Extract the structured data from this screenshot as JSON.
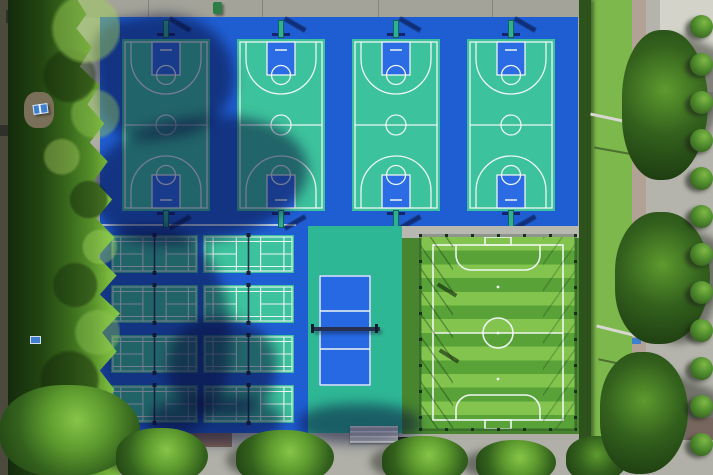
{
  "scene": {
    "type": "aerial-drone-photo",
    "description": "Top-down aerial view of an outdoor sports complex: four basketball courts along the north side, a grid of badminton courts and a volleyball court in the south-west, and a fenced artificial-turf football pitch in the south-east. A dense tree line borders the west edge, a row of trees the south edge, and on the east a hedge, lawn, footpath and road lined with round shrubs.",
    "facilities": [
      {
        "name": "basketball-court",
        "count": 4,
        "surface": "green acrylic with blue keys and white lines"
      },
      {
        "name": "badminton-court",
        "count": 8,
        "arrangement": "2 columns x 4 rows with nets"
      },
      {
        "name": "volleyball-court",
        "count": 1,
        "surface": "blue court on teal surround with net"
      },
      {
        "name": "football-pitch",
        "count": 1,
        "surface": "striped artificial turf, fenced, goals at both ends"
      },
      {
        "name": "table-tennis-table",
        "count": 1,
        "location": "clearing in west tree line"
      }
    ],
    "surroundings": [
      "concrete apron along north edge",
      "tree line west",
      "tree row south over pavement",
      "hedge + lawn + footpath + road east",
      "round shrub row along east road"
    ]
  },
  "counts": {
    "basketball_courts": 4,
    "badminton_rows": 4,
    "badminton_cols": 2,
    "east_shrubs": 12,
    "turf_stripe_height_px": 13.7
  },
  "colors": {
    "pavement_top": "#a3a399",
    "pavement_bottom": "#b0b0a8",
    "road_gray": "#b4b4ac",
    "path_tan": "#b2a296",
    "grass_green": "#7cb84c",
    "hedge_green": "#2d521c",
    "surround_blue": "#1f5ed2",
    "key_blue": "#2b6ce4",
    "court_green": "#3cc29c",
    "volley_surround": "#2eb795",
    "volley_blue": "#2669e2",
    "turf_light": "#82c44d",
    "turf_dark": "#58a238",
    "turf_margin": "#47862f",
    "line_white": "#edf6f2",
    "tree_dark": "#1c3a10",
    "tree_mid": "#33611d",
    "tree_light": "#5d9a2e",
    "tree_bright": "#86c548",
    "bush_green": "#4e8b2d",
    "hoop_teal": "#2fb093",
    "hoop_navy": "#16246e",
    "net_dark": "#27314d",
    "table_blue": "#3f7fd0"
  }
}
